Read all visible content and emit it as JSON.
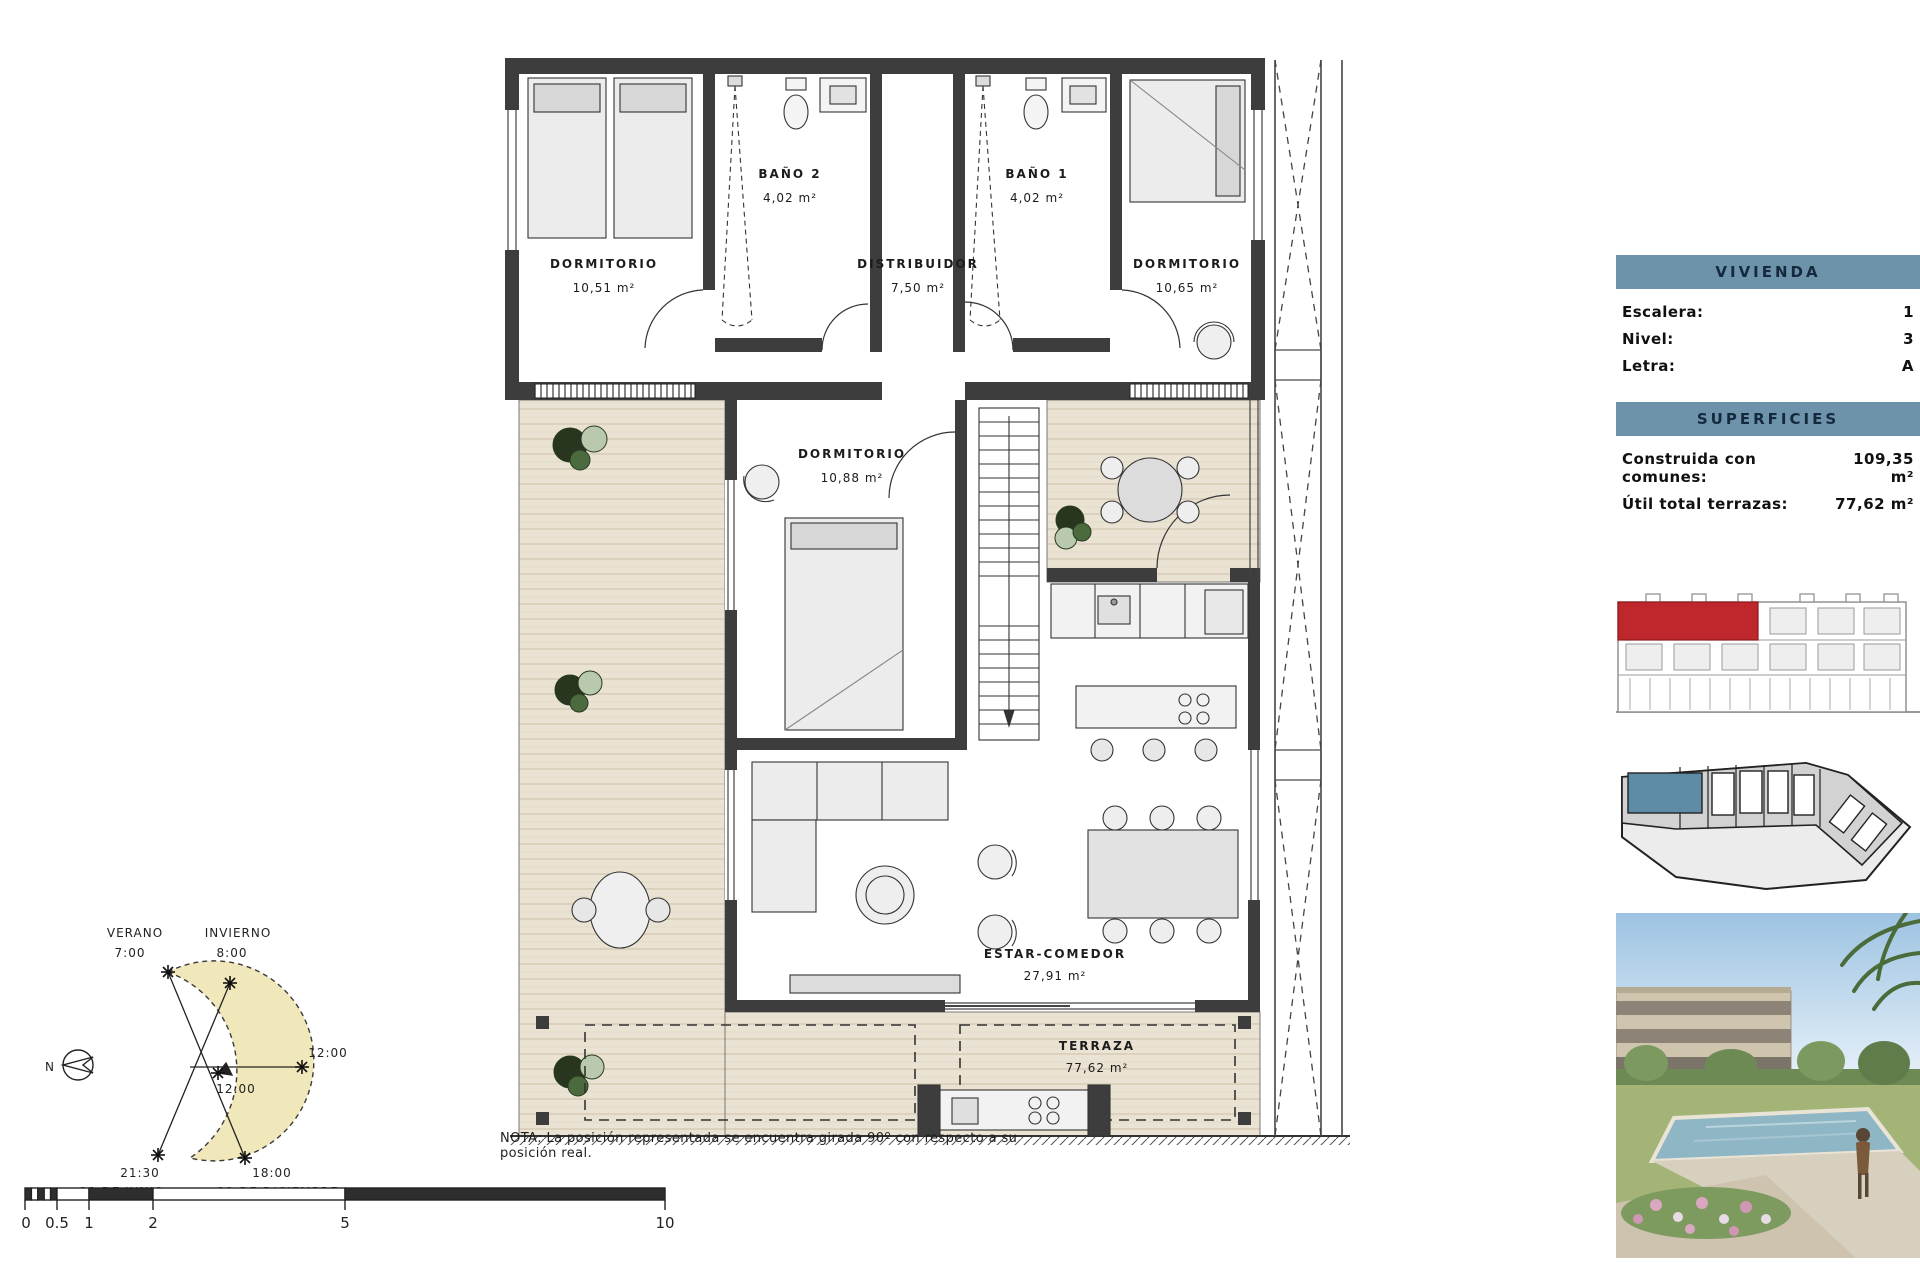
{
  "plan": {
    "rooms": {
      "dormitorio_tl": {
        "name": "DORMITORIO",
        "area": "10,51 m²"
      },
      "bano2": {
        "name": "BAÑO 2",
        "area": "4,02 m²"
      },
      "distribuidor": {
        "name": "DISTRIBUIDOR",
        "area": "7,50 m²"
      },
      "bano1": {
        "name": "BAÑO 1",
        "area": "4,02 m²"
      },
      "dormitorio_tr": {
        "name": "DORMITORIO",
        "area": "10,65 m²"
      },
      "dormitorio_c": {
        "name": "DORMITORIO",
        "area": "10,88 m²"
      },
      "estar_comedor": {
        "name": "ESTAR-COMEDOR",
        "area": "27,91 m²"
      },
      "terraza": {
        "name": "TERRAZA",
        "area": "77,62 m²"
      }
    },
    "note": "NOTA: La posición representada se encuentra girada 90º con respecto a su posición real."
  },
  "sun_diagram": {
    "verano_label": "VERANO",
    "verano_time": "7:00",
    "invierno_label": "INVIERNO",
    "invierno_time": "8:00",
    "noon_outer": "12:00",
    "noon_inner": "12:00",
    "june_time": "21:30",
    "june_date": "21 DE JUNIO",
    "december_time": "18:00",
    "december_date": "21 DE DICIEMBRE",
    "north_label": "N"
  },
  "scale_bar": {
    "ticks": [
      "0",
      "0.5",
      "1",
      "2",
      "5",
      "10"
    ]
  },
  "info_panel": {
    "vivienda_title": "VIVIENDA",
    "fields": [
      {
        "label": "Escalera:",
        "value": "1"
      },
      {
        "label": "Nivel:",
        "value": "3"
      },
      {
        "label": "Letra:",
        "value": "A"
      }
    ],
    "superficies_title": "SUPERFICIES",
    "areas": [
      {
        "label": "Construida con comunes:",
        "value": "109,35 m²"
      },
      {
        "label": "Útil total terrazas:",
        "value": "77,62 m²"
      }
    ]
  },
  "colors": {
    "header_bg": "#6d93ab",
    "header_text": "#14293e",
    "highlight_red": "#c0272d",
    "highlight_blue": "#5e8ca6",
    "wall": "#3d3d3d",
    "wood": "#eae3d3",
    "sun_fill": "#f0e7ba"
  }
}
